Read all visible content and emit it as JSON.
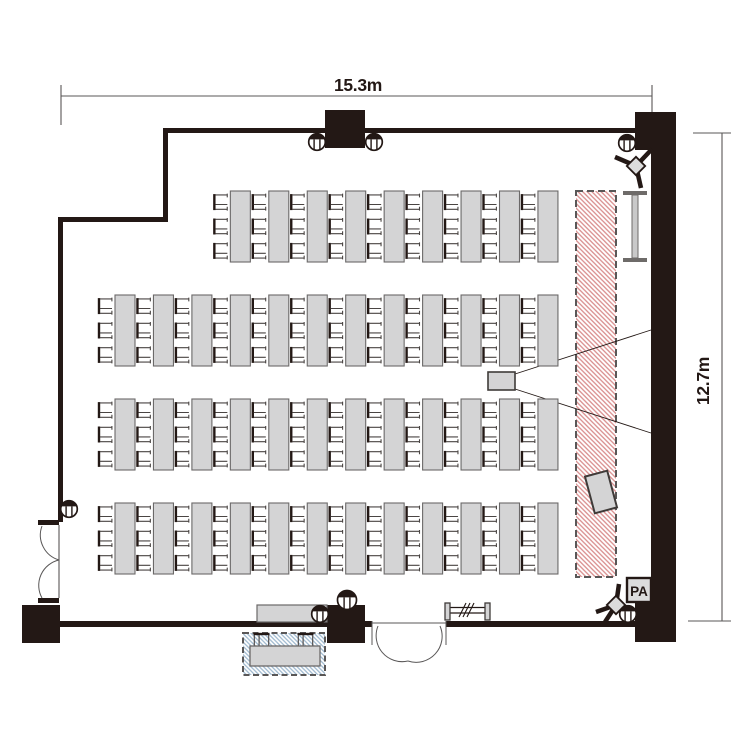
{
  "page": {
    "title": "Seminar room floor plan"
  },
  "dimensions": {
    "width_label": "15.3m",
    "height_label": "12.7m"
  },
  "labels": {
    "pa": "PA"
  },
  "colors": {
    "wall": "#231815",
    "line": "#595757",
    "thin_stroke": "#4a4543",
    "desk_fill": "#d4d4d5",
    "desk_stroke": "#6b6969",
    "equip_fill": "#dcdcdc",
    "screen_hatch": "#d98f8f",
    "reception_hatch": "#9fb9cf",
    "white": "#ffffff"
  },
  "seating": {
    "chairs_per_desk": 3,
    "desk_count": 45,
    "seat_count": 135,
    "col_origin_x": 97,
    "col_pitch": 38.45,
    "desk_offset_x": 18,
    "desk_w": 20,
    "desk_h": 71,
    "chair_offsets_y": [
      2.6,
      27,
      51.4
    ],
    "rows": [
      {
        "y": 191,
        "start_col": 3,
        "desks": 9
      },
      {
        "y": 295,
        "start_col": 0,
        "desks": 12
      },
      {
        "y": 399,
        "start_col": 0,
        "desks": 12
      },
      {
        "y": 503,
        "start_col": 0,
        "desks": 12
      }
    ]
  },
  "layout": {
    "walls": [
      [
        163,
        128,
        492,
        5
      ],
      [
        163,
        128,
        5,
        94
      ],
      [
        58,
        217,
        110,
        5
      ],
      [
        58,
        217,
        5,
        305
      ],
      [
        58,
        621,
        314,
        6
      ],
      [
        446,
        621,
        206,
        6
      ],
      [
        651,
        112,
        25,
        530
      ]
    ],
    "columns": [
      [
        325,
        110,
        40,
        38
      ],
      [
        635,
        112,
        41,
        38
      ],
      [
        22,
        605,
        38,
        38
      ],
      [
        327,
        605,
        38,
        38
      ],
      [
        635,
        603,
        41,
        39
      ]
    ],
    "jambs": [
      [
        38,
        520,
        21,
        5
      ],
      [
        38,
        598,
        21,
        5
      ]
    ],
    "doors": {
      "left": {
        "leaf": "M59 525 V598",
        "arcs": [
          "M42 526 A26 26 0 0 0 59 560",
          "M42 598 A26 26 0 0 1 59 560"
        ],
        "jamb_lines": []
      },
      "bottom": {
        "leaf": "M372 623 H446",
        "arcs": [
          "M378 626 A26 26 0 0 0 408 661",
          "M440 626 A26 26 0 0 1 408 661"
        ],
        "jamb_lines": [
          "M372 621 V645",
          "M446 621 V645"
        ]
      }
    },
    "dims": {
      "top": {
        "line": "M61 96 H652",
        "ticks": [
          "M61 85 V125",
          "M652 85 V112"
        ],
        "label_x": 358,
        "label_y": 91
      },
      "right": {
        "line": "M722 133 V621",
        "ticks": [
          "M693 133 H731",
          "M688 621 H731"
        ],
        "label_x": 709,
        "label_y": 381
      }
    },
    "screen": {
      "x": 576,
      "y": 191,
      "w": 40,
      "h": 386
    },
    "projector": {
      "x": 488,
      "y": 372,
      "w": 27,
      "h": 18
    },
    "beams": [
      "M515 374 L651 330",
      "M515 389 L651 433"
    ],
    "whiteboard": {
      "x": 623,
      "y": 191,
      "w": 24,
      "bar_h": 4,
      "h": 71
    },
    "monitor": {
      "cx": 601,
      "cy": 492,
      "w": 23,
      "h": 38,
      "angle": -15
    },
    "speakers": [
      {
        "cx": 636,
        "cy": 166,
        "legs": [
          [
            615,
            157
          ],
          [
            641,
            188
          ],
          [
            652,
            149
          ]
        ]
      },
      {
        "cx": 616,
        "cy": 605,
        "legs": [
          [
            596,
            612
          ],
          [
            619,
            584
          ],
          [
            605,
            622
          ]
        ]
      }
    ],
    "pa": {
      "x": 627,
      "y": 578,
      "w": 24,
      "h": 24,
      "label_x": 639,
      "label_y": 596
    },
    "podium": {
      "x": 257,
      "y": 605,
      "w": 70,
      "h": 17
    },
    "reception": {
      "box": [
        243,
        633,
        82,
        42
      ],
      "desk": [
        250,
        646,
        70,
        20
      ],
      "chairs_x": [
        253,
        297
      ],
      "chairs_y": 632
    },
    "coat_rack": {
      "posts": [
        [
          445,
          603
        ],
        [
          485,
          603
        ]
      ],
      "post_w": 5,
      "post_h": 17,
      "rails": [
        "M450 607.5 H485",
        "M450 613 H485"
      ],
      "slashes": [
        "M459 617 L466 603",
        "M463 617 L470 603",
        "M467 617 L474 603"
      ]
    },
    "outlets": [
      [
        317,
        142,
        8.3
      ],
      [
        374,
        142,
        8.3
      ],
      [
        627,
        143,
        8.3
      ],
      [
        69,
        509,
        8.3
      ],
      [
        320,
        614,
        8.3
      ],
      [
        347,
        600,
        9.5
      ],
      [
        628,
        614,
        8.3
      ]
    ]
  }
}
